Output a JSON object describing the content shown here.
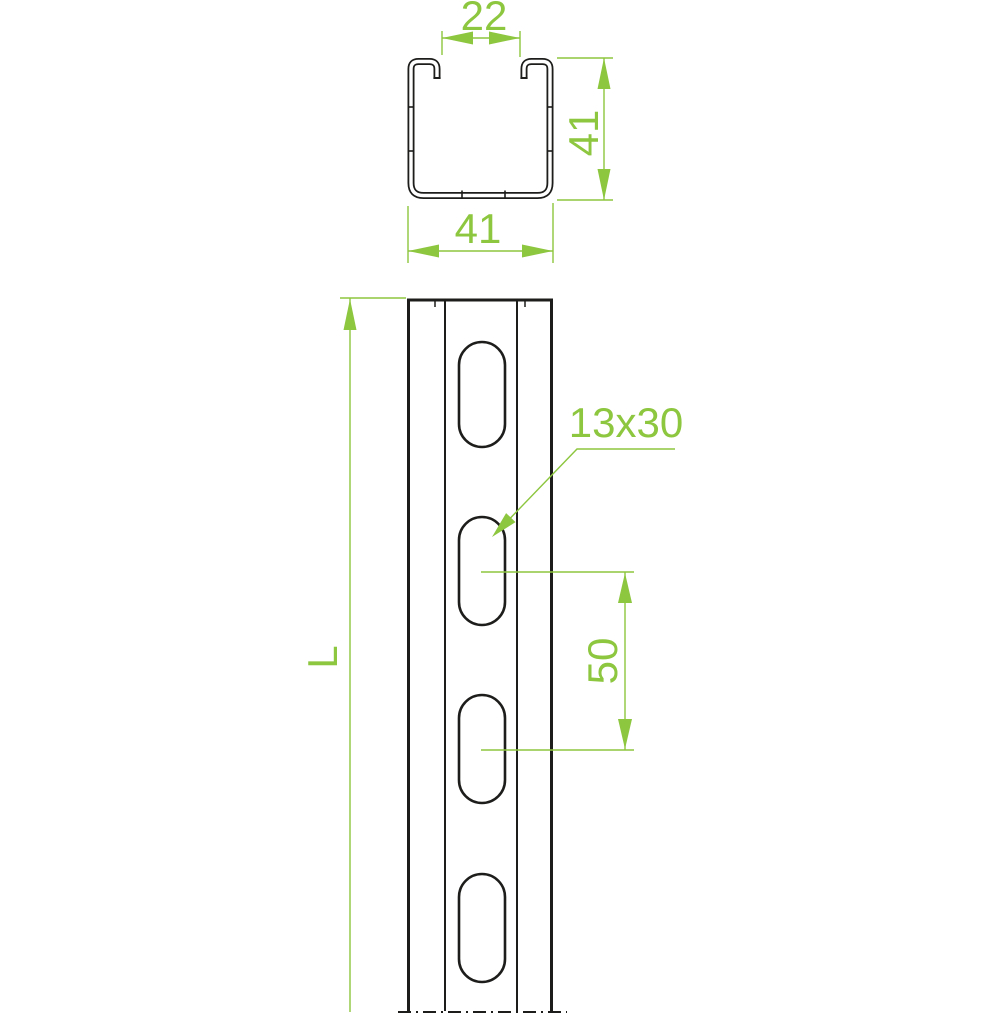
{
  "drawing": {
    "kind": "strut-channel technical drawing",
    "colors": {
      "outline": "#1d1d1b",
      "dimension": "#8dc63f",
      "background": "#ffffff"
    },
    "cross_section": {
      "opening_width": "22",
      "height": "41",
      "width": "41"
    },
    "elevation": {
      "length_label": "L",
      "slot_size_label": "13x30",
      "slot_spacing": "50",
      "slot_count": 4
    }
  }
}
